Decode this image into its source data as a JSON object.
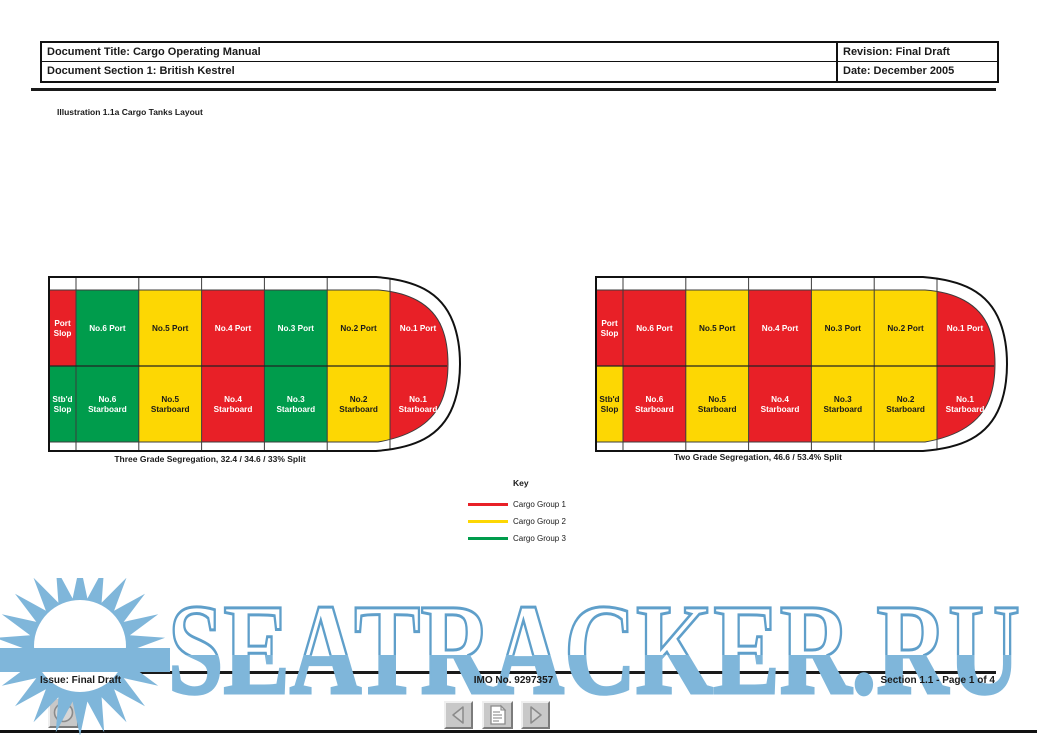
{
  "header": {
    "document_title": "Document Title: Cargo Operating Manual",
    "document_section": "Document Section 1: British Kestrel",
    "revision": "Revision: Final Draft",
    "date": "Date: December 2005"
  },
  "illustration_title": "Illustration 1.1a Cargo Tanks Layout",
  "groups": {
    "1": {
      "name": "Cargo Group 1",
      "color": "#e82027",
      "text_color": "#ffffff"
    },
    "2": {
      "name": "Cargo Group 2",
      "color": "#fdd703",
      "text_color": "#1a1a1a"
    },
    "3": {
      "name": "Cargo Group 3",
      "color": "#009c4c",
      "text_color": "#ffffff"
    }
  },
  "chart_data": [
    {
      "type": "ship-tank-layout",
      "caption": "Three Grade Segregation, 32.4 / 34.6 / 33% Split",
      "port_row": [
        {
          "lines": [
            "Port",
            "Slop"
          ],
          "group": 1
        },
        {
          "lines": [
            "No.6 Port"
          ],
          "group": 3
        },
        {
          "lines": [
            "No.5 Port"
          ],
          "group": 2
        },
        {
          "lines": [
            "No.4 Port"
          ],
          "group": 1
        },
        {
          "lines": [
            "No.3 Port"
          ],
          "group": 3
        },
        {
          "lines": [
            "No.2 Port"
          ],
          "group": 2
        },
        {
          "lines": [
            "No.1 Port"
          ],
          "group": 1
        }
      ],
      "starboard_row": [
        {
          "lines": [
            "Stb'd",
            "Slop"
          ],
          "group": 3
        },
        {
          "lines": [
            "No.6",
            "Starboard"
          ],
          "group": 3
        },
        {
          "lines": [
            "No.5",
            "Starboard"
          ],
          "group": 2
        },
        {
          "lines": [
            "No.4",
            "Starboard"
          ],
          "group": 1
        },
        {
          "lines": [
            "No.3",
            "Starboard"
          ],
          "group": 3
        },
        {
          "lines": [
            "No.2",
            "Starboard"
          ],
          "group": 2
        },
        {
          "lines": [
            "No.1",
            "Starboard"
          ],
          "group": 1
        }
      ]
    },
    {
      "type": "ship-tank-layout",
      "caption": "Two Grade Segregation, 46.6 / 53.4% Split",
      "port_row": [
        {
          "lines": [
            "Port",
            "Slop"
          ],
          "group": 1
        },
        {
          "lines": [
            "No.6 Port"
          ],
          "group": 1
        },
        {
          "lines": [
            "No.5 Port"
          ],
          "group": 2
        },
        {
          "lines": [
            "No.4 Port"
          ],
          "group": 1
        },
        {
          "lines": [
            "No.3 Port"
          ],
          "group": 2
        },
        {
          "lines": [
            "No.2 Port"
          ],
          "group": 2
        },
        {
          "lines": [
            "No.1 Port"
          ],
          "group": 1
        }
      ],
      "starboard_row": [
        {
          "lines": [
            "Stb'd",
            "Slop"
          ],
          "group": 2
        },
        {
          "lines": [
            "No.6",
            "Starboard"
          ],
          "group": 1
        },
        {
          "lines": [
            "No.5",
            "Starboard"
          ],
          "group": 2
        },
        {
          "lines": [
            "No.4",
            "Starboard"
          ],
          "group": 1
        },
        {
          "lines": [
            "No.3",
            "Starboard"
          ],
          "group": 2
        },
        {
          "lines": [
            "No.2",
            "Starboard"
          ],
          "group": 2
        },
        {
          "lines": [
            "No.1",
            "Starboard"
          ],
          "group": 1
        }
      ]
    }
  ],
  "key": {
    "title": "Key",
    "entries": [
      {
        "label": "Cargo Group 1",
        "color": "#e82027"
      },
      {
        "label": "Cargo Group 2",
        "color": "#fdd703"
      },
      {
        "label": "Cargo Group 3",
        "color": "#009c4c"
      }
    ]
  },
  "footer": {
    "issue": "Issue: Final Draft",
    "imo": "IMO No. 9297357",
    "section_page": "Section 1.1 - Page 1 of 4"
  },
  "watermark": {
    "text": "SEATRACKER.RU",
    "fill": "#7fb6da",
    "outline": "#5f9fca"
  }
}
